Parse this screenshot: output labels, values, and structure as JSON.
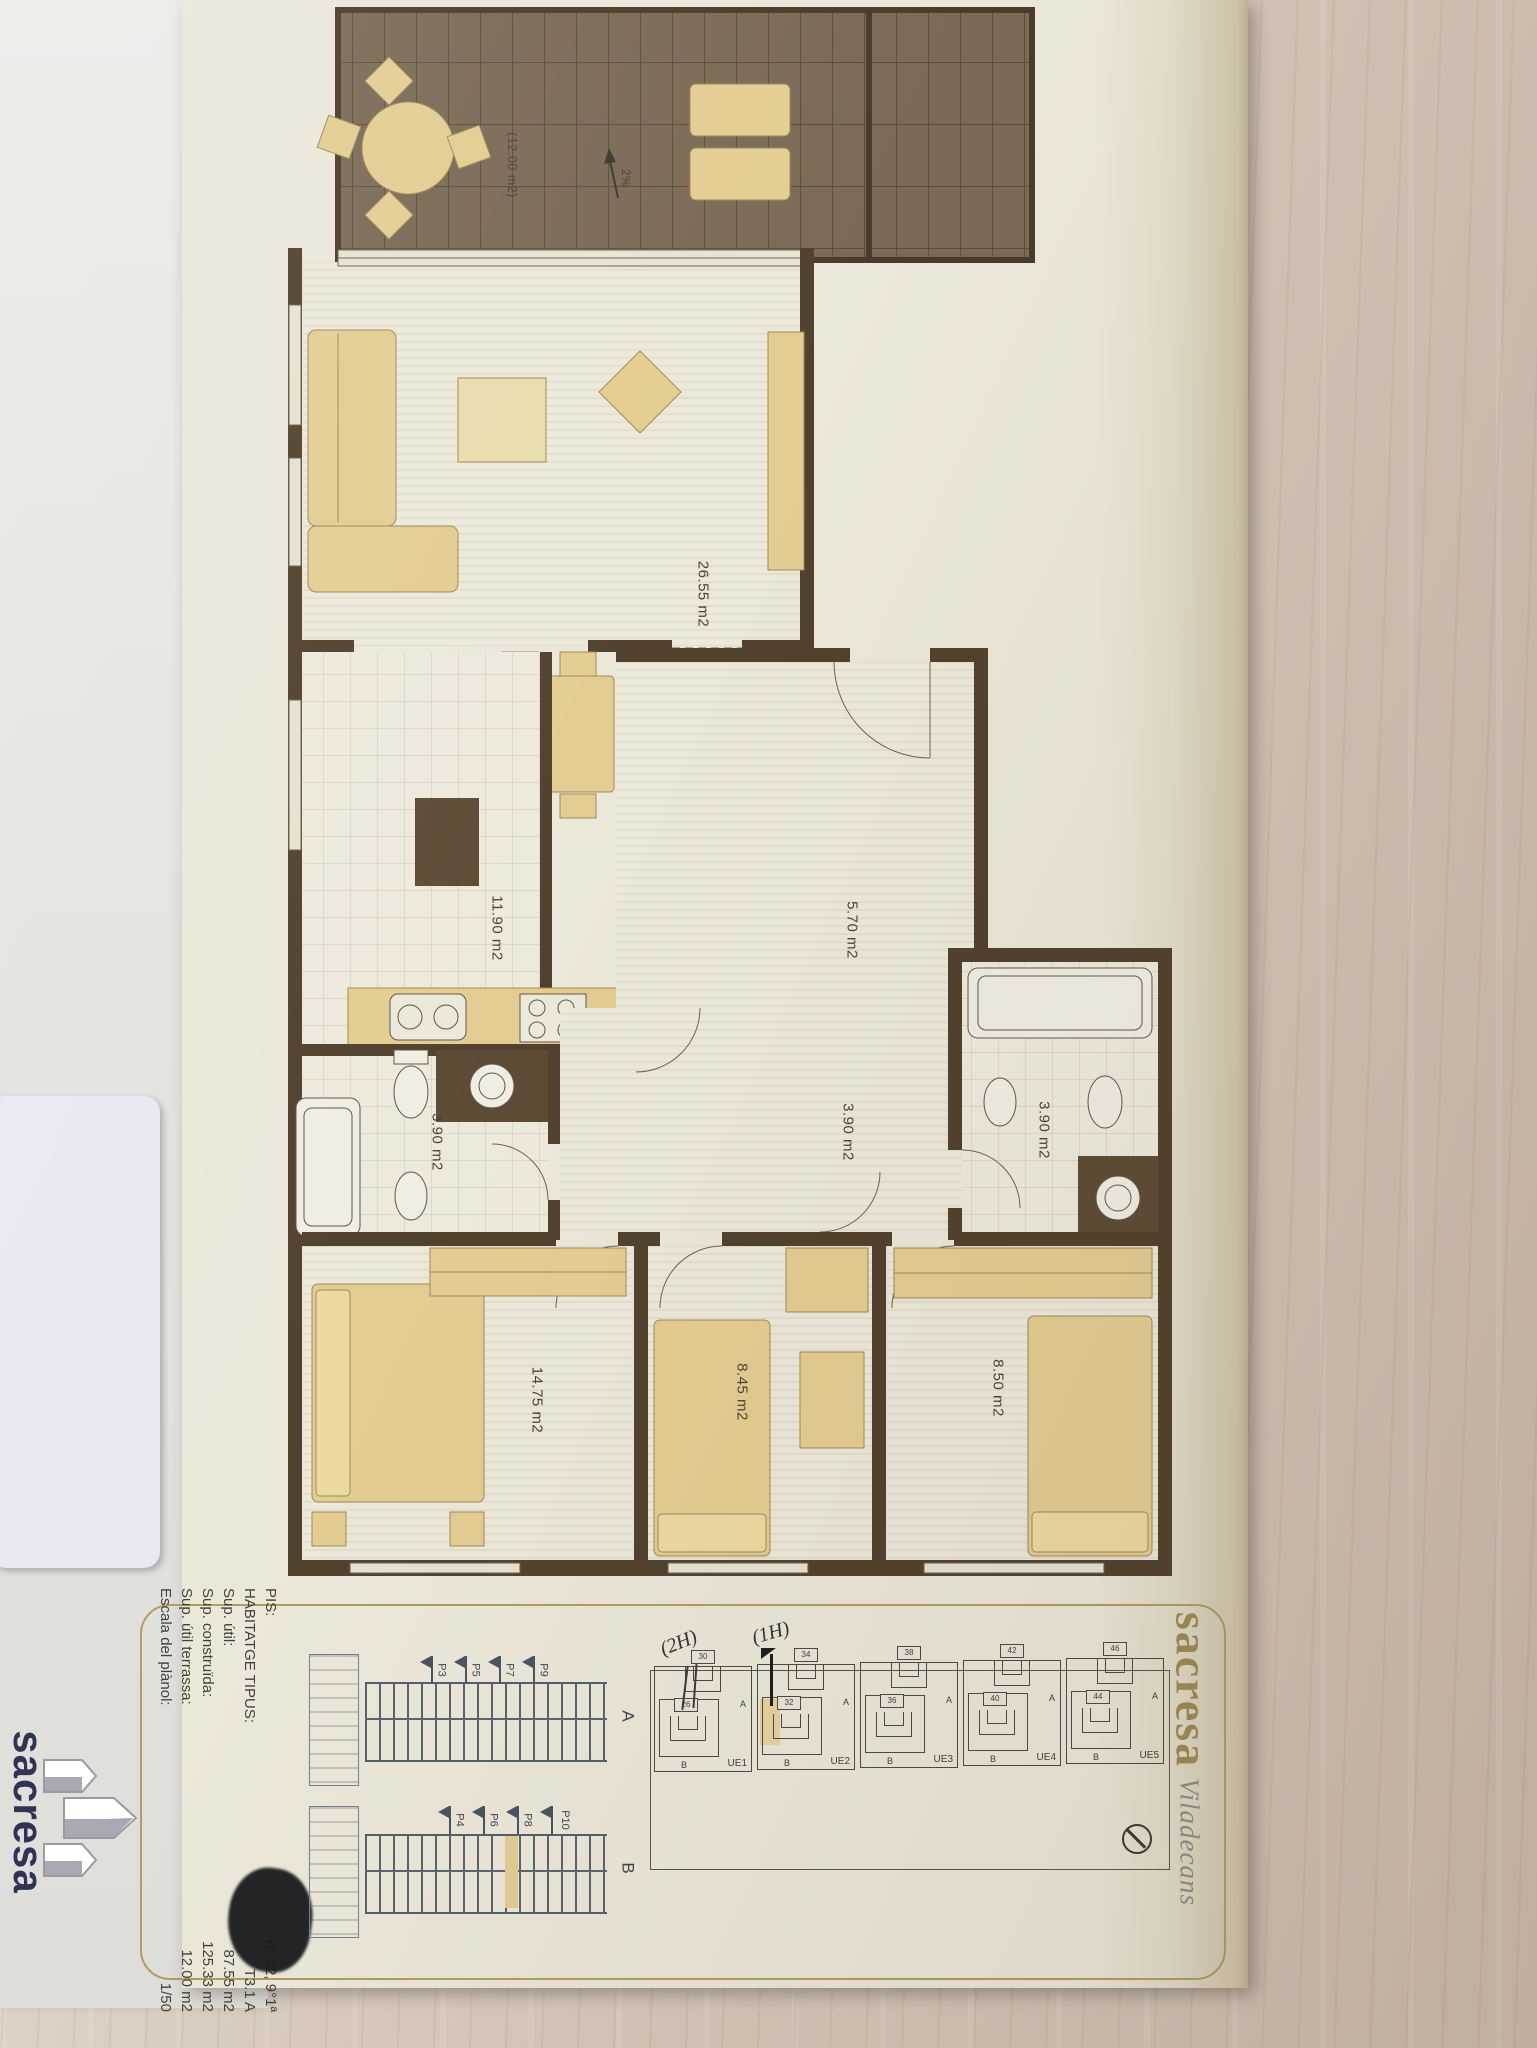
{
  "brand_panel": {
    "brand": "sacresa",
    "city": "Viladecans"
  },
  "back_panel": {
    "logo_text": "sacresa"
  },
  "plan": {
    "areas": {
      "terrace": "(12.00 m2)",
      "terrace_slope": "2%",
      "living": "26.55 m2",
      "kitchen": "11.90 m2",
      "hall": "5.70 m2",
      "corridor": "3.90 m2",
      "bath_left": "3.90 m2",
      "bath_right": "3.90 m2",
      "bedroom_main": "14.75 m2",
      "bedroom_2": "8.45 m2",
      "bedroom_3": "8.50 m2"
    }
  },
  "legend": {
    "rows": [
      {
        "label": "PIS:",
        "value": "n° 32, 9°1ª"
      },
      {
        "label": "HABITATGE TIPUS:",
        "value": "T3.1 A"
      },
      {
        "label": "Sup. útil:",
        "value": "87.55 m2"
      },
      {
        "label": "Sup. construïda:",
        "value": "125.33 m2"
      },
      {
        "label": "Sup. útil terrassa:",
        "value": "12.00 m2"
      },
      {
        "label": "Escala del plànol:",
        "value": "1/50"
      }
    ]
  },
  "site_plan": {
    "units": [
      {
        "name": "UE1",
        "a_label": "A",
        "b_label": "B",
        "a_number": "30",
        "b_number": "26"
      },
      {
        "name": "UE2",
        "a_label": "A",
        "b_label": "B",
        "a_number": "34",
        "b_number": "32"
      },
      {
        "name": "UE3",
        "a_label": "A",
        "b_label": "B",
        "a_number": "38",
        "b_number": "36"
      },
      {
        "name": "UE4",
        "a_label": "A",
        "b_label": "B",
        "a_number": "42",
        "b_number": "40"
      },
      {
        "name": "UE5",
        "a_label": "A",
        "b_label": "B",
        "a_number": "46",
        "b_number": "44"
      }
    ],
    "handwritten": [
      {
        "text": "(2H)"
      },
      {
        "text": "(1H)"
      }
    ]
  },
  "sections": [
    {
      "label": "A",
      "flags": [
        "P3",
        "P5",
        "P7",
        "P9"
      ]
    },
    {
      "label": "B",
      "flags": [
        "P4",
        "P6",
        "P8",
        "P10"
      ]
    }
  ]
}
